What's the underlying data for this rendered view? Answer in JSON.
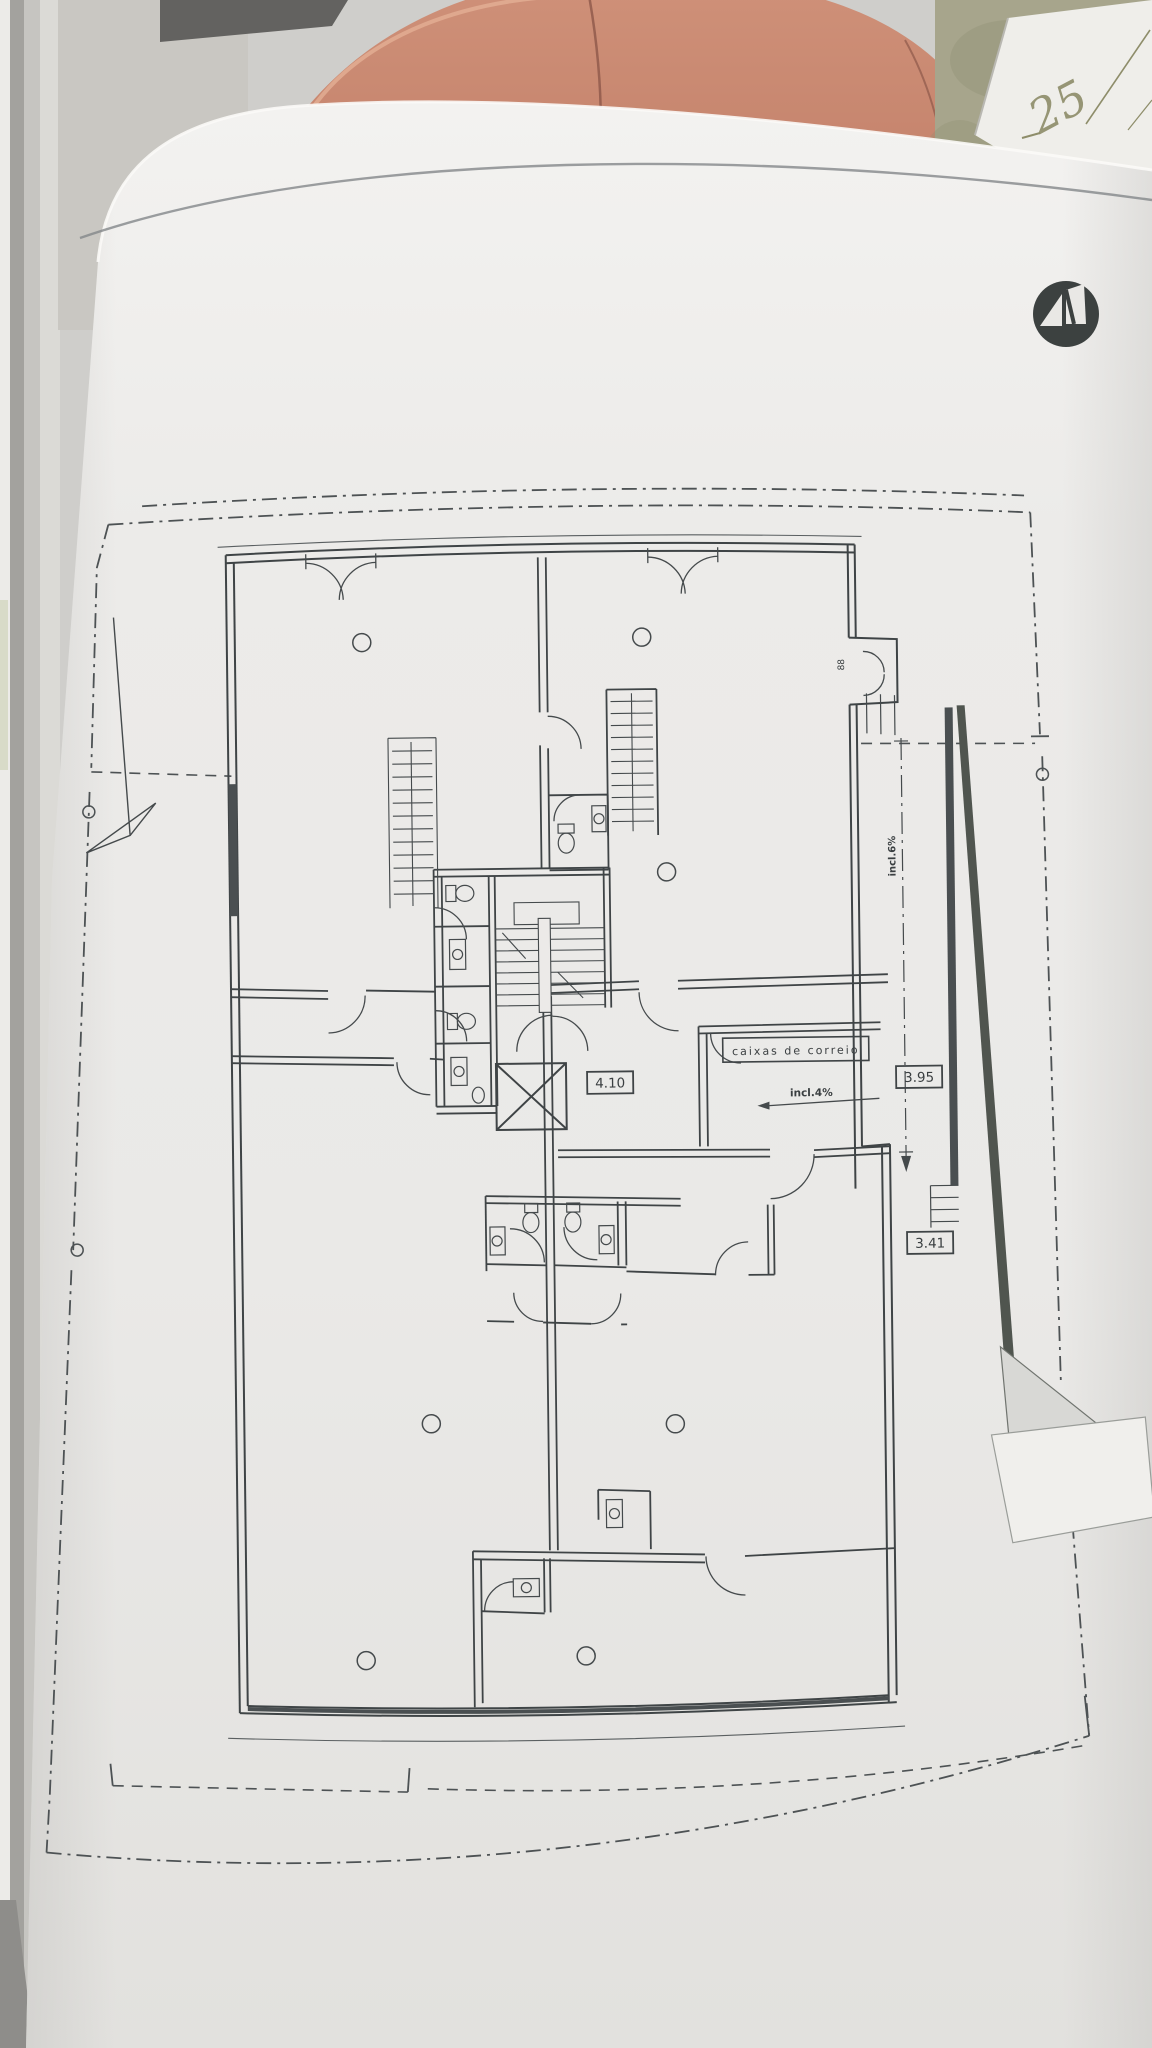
{
  "background": {
    "handwritten_number": "25"
  },
  "plan": {
    "labels": {
      "mailboxes": "caixas de correio",
      "hall_slope": "incl.4%",
      "ramp_slope": "incl.6%",
      "entry_note": "88"
    },
    "dimensions": {
      "hall_width": "4.10",
      "ramp_width_upper": "3.95",
      "ramp_width_lower": "3.41"
    }
  },
  "colors": {
    "paper": "#edecea",
    "ink": "#454a4c",
    "boundary": "#4d5254",
    "salmon_object": "#c5836c",
    "olive_background": "#a7a58c",
    "window_frame": "#c6c5c1",
    "logo_circle": "#3c4140",
    "handwriting_ink": "#8d8c69"
  }
}
